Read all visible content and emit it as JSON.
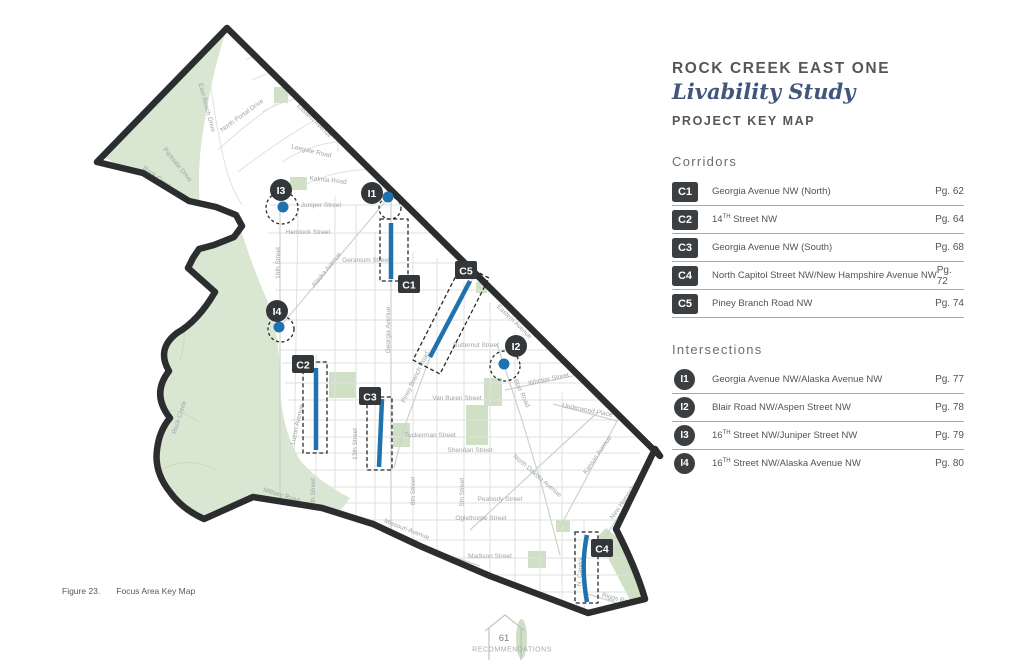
{
  "header": {
    "title": "ROCK CREEK EAST ONE",
    "subtitle": "Livability Study",
    "section": "PROJECT KEY MAP"
  },
  "corridors": {
    "heading": "Corridors",
    "rows": [
      {
        "id": "C1",
        "pre": "Georgia Avenue NW (North)",
        "sup": "",
        "rest": "",
        "page": "Pg. 62"
      },
      {
        "id": "C2",
        "pre": "14",
        "sup": "TH",
        "rest": " Street NW",
        "page": "Pg. 64"
      },
      {
        "id": "C3",
        "pre": "Georgia Avenue NW (South)",
        "sup": "",
        "rest": "",
        "page": "Pg. 68"
      },
      {
        "id": "C4",
        "pre": "North Capitol Street NW/New Hampshire Avenue NW",
        "sup": "",
        "rest": "",
        "page": "Pg. 72"
      },
      {
        "id": "C5",
        "pre": "Piney Branch Road NW",
        "sup": "",
        "rest": "",
        "page": "Pg. 74"
      }
    ]
  },
  "intersections": {
    "heading": "Intersections",
    "rows": [
      {
        "id": "I1",
        "pre": "Georgia Avenue NW/Alaska Avenue NW",
        "sup": "",
        "rest": "",
        "page": "Pg. 77"
      },
      {
        "id": "I2",
        "pre": "Blair Road NW/Aspen Street NW",
        "sup": "",
        "rest": "",
        "page": "Pg. 78"
      },
      {
        "id": "I3",
        "pre": "16",
        "sup": "TH",
        "rest": " Street NW/Juniper Street NW",
        "page": "Pg. 79"
      },
      {
        "id": "I4",
        "pre": "16",
        "sup": "TH",
        "rest": " Street NW/Alaska Avenue NW",
        "page": "Pg. 80"
      }
    ]
  },
  "caption": {
    "figure": "Figure 23.",
    "title": "Focus Area Key Map"
  },
  "footer": {
    "page": "61",
    "label": "RECOMMENDATIONS"
  },
  "colors": {
    "accent_blue": "#1f72ad",
    "badge_dark": "#3b3f42",
    "park_green": "#d9e6d1",
    "script_blue": "#42567d",
    "boundary": "#2b2d2f"
  },
  "map": {
    "street_labels": [
      {
        "t": "East Beach Drive",
        "x": 205,
        "y": 108,
        "r": 75
      },
      {
        "t": "North Portal Drive",
        "x": 243,
        "y": 117,
        "r": -36
      },
      {
        "t": "Eastern Avenue",
        "x": 313,
        "y": 122,
        "r": 44
      },
      {
        "t": "Leegate Road",
        "x": 311,
        "y": 153,
        "r": 13
      },
      {
        "t": "Kalmia Road",
        "x": 328,
        "y": 182,
        "r": 6
      },
      {
        "t": "Juniper Street",
        "x": 321,
        "y": 207,
        "r": 0
      },
      {
        "t": "Hemlock Street",
        "x": 308,
        "y": 234,
        "r": 0
      },
      {
        "t": "Geranium Street",
        "x": 366,
        "y": 262,
        "r": 0
      },
      {
        "t": "Alaska Avenue",
        "x": 328,
        "y": 271,
        "r": -51
      },
      {
        "t": "Georgia Avenue",
        "x": 390,
        "y": 330,
        "r": -90
      },
      {
        "t": "16th Street",
        "x": 280,
        "y": 263,
        "r": -90
      },
      {
        "t": "Piney Branch Road",
        "x": 417,
        "y": 378,
        "r": -64
      },
      {
        "t": "Butternut Street",
        "x": 476,
        "y": 347,
        "r": 0
      },
      {
        "t": "Whittier Street",
        "x": 549,
        "y": 381,
        "r": -12
      },
      {
        "t": "Blair Road",
        "x": 520,
        "y": 394,
        "r": 65
      },
      {
        "t": "Eastern Avenue",
        "x": 513,
        "y": 323,
        "r": 44
      },
      {
        "t": "Van Buren Street",
        "x": 457,
        "y": 400,
        "r": 0
      },
      {
        "t": "Underwood Place",
        "x": 587,
        "y": 412,
        "r": 11
      },
      {
        "t": "Tuckerman Street",
        "x": 430,
        "y": 437,
        "r": 0
      },
      {
        "t": "Sheridan Street",
        "x": 470,
        "y": 452,
        "r": 0
      },
      {
        "t": "North Dakota Avenue",
        "x": 536,
        "y": 477,
        "r": 41
      },
      {
        "t": "Kansas Avenue",
        "x": 599,
        "y": 456,
        "r": -55
      },
      {
        "t": "5th Street",
        "x": 464,
        "y": 492,
        "r": -90
      },
      {
        "t": "8th Street",
        "x": 415,
        "y": 491,
        "r": -90
      },
      {
        "t": "Peabody Street",
        "x": 500,
        "y": 501,
        "r": 0
      },
      {
        "t": "Oglethorpe Street",
        "x": 481,
        "y": 520,
        "r": 0
      },
      {
        "t": "Madison Street",
        "x": 490,
        "y": 558,
        "r": 0
      },
      {
        "t": "Missouri Avenue",
        "x": 406,
        "y": 531,
        "r": 21
      },
      {
        "t": "Military Road",
        "x": 281,
        "y": 497,
        "r": 17
      },
      {
        "t": "14th Street",
        "x": 315,
        "y": 494,
        "r": -90
      },
      {
        "t": "13th Street",
        "x": 357,
        "y": 444,
        "r": -90
      },
      {
        "t": "Luzon Avenue",
        "x": 299,
        "y": 425,
        "r": -77
      },
      {
        "t": "Rock Creek",
        "x": 156,
        "y": 179,
        "r": 37
      },
      {
        "t": "Parkside Drive",
        "x": 176,
        "y": 166,
        "r": 51
      },
      {
        "t": "Rock Creek",
        "x": 181,
        "y": 418,
        "r": -72
      },
      {
        "t": "N. Capitol",
        "x": 582,
        "y": 572,
        "r": -86
      },
      {
        "t": "Riggs Road",
        "x": 618,
        "y": 601,
        "r": 15
      },
      {
        "t": "New Hampshire Avenue",
        "x": 633,
        "y": 491,
        "r": -55
      }
    ],
    "corridor_markers": [
      {
        "label": "C1",
        "dash": "M380,219 L408,219 L408,281 L380,281 Z",
        "line": "M391,223 L391,279",
        "lx": 398,
        "ly": 275
      },
      {
        "label": "C2",
        "dash": "M303,362 L327,362 L327,453 L303,453 Z",
        "line": "M316,368 L316,450",
        "lx": 292,
        "ly": 355
      },
      {
        "label": "C3",
        "dash": "M367,397 L392,397 L392,470 L367,470 Z",
        "line": "M382,399 L379,467",
        "lx": 359,
        "ly": 387
      },
      {
        "label": "C4",
        "dash": "M575,532 L598,532 L598,603 L575,603 Z",
        "line": "M587,535 C582,558 583,580 587,602",
        "lx": 591,
        "ly": 539
      },
      {
        "label": "C5",
        "dash": "M462,264 L489,278 L440,374 L413,360 Z",
        "line": "M470,281 L430,357",
        "lx": 455,
        "ly": 261
      }
    ],
    "intersection_markers": [
      {
        "label": "I1",
        "bx": 372,
        "by": 193,
        "dcx": 390,
        "dcy": 208,
        "dr": 11,
        "dx": 388,
        "dy": 197
      },
      {
        "label": "I2",
        "bx": 516,
        "by": 346,
        "dcx": 505,
        "dcy": 366,
        "dr": 15,
        "dx": 504,
        "dy": 364
      },
      {
        "label": "I3",
        "bx": 281,
        "by": 190,
        "dcx": 282,
        "dcy": 208,
        "dr": 16,
        "dx": 283,
        "dy": 207
      },
      {
        "label": "I4",
        "bx": 277,
        "by": 311,
        "dcx": 281,
        "dcy": 329,
        "dr": 13,
        "dx": 279,
        "dy": 327
      }
    ]
  }
}
